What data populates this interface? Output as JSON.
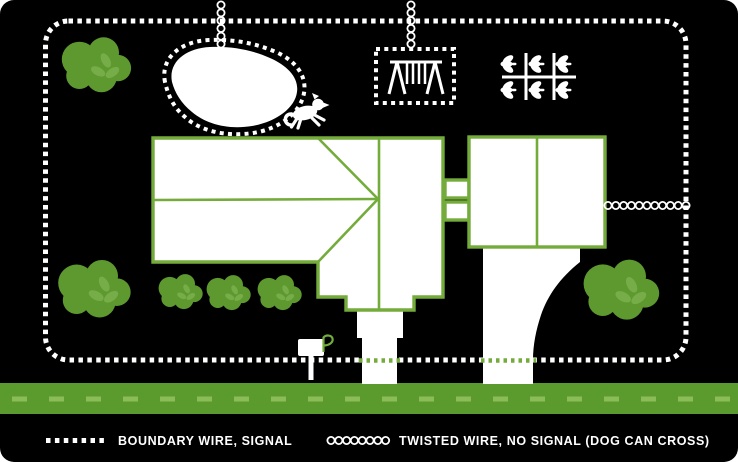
{
  "legend": {
    "items": [
      {
        "label": "BOUNDARY WIRE, SIGNAL",
        "symbol": "dotted-line",
        "symbol_color": "#ffffff"
      },
      {
        "label": "TWISTED WIRE, NO SIGNAL (DOG CAN CROSS)",
        "symbol": "twisted-loop-chain",
        "symbol_color": "#ffffff"
      }
    ]
  },
  "colors": {
    "background": "#000000",
    "wire_white": "#ffffff",
    "outline_green": "#74ac3c",
    "road_green": "#5b9b2e",
    "road_dash_green": "#8bbc57",
    "bush_green": "#5e9930",
    "leaf_green": "#77ad49",
    "crossing_dot_green": "#74ac3c"
  },
  "icons": {
    "boundary_wire": "dotted perimeter loop around the yard",
    "pool": "kidney-shaped pool with dotted exclusion loop",
    "swing_set": "swing set inside dotted exclusion rectangle",
    "garden": "garden plot grid with six sprouts",
    "house": "house footprint with hip roof and porch",
    "garage": "two-bay garage connected by breezeway",
    "driveway": "driveway from garage to road",
    "walkway": "front walkway to road",
    "mailbox": "mailbox with raised flag",
    "dog": "running dog silhouette",
    "bushes": "six round shrubs",
    "road": "street with dashed center line"
  }
}
